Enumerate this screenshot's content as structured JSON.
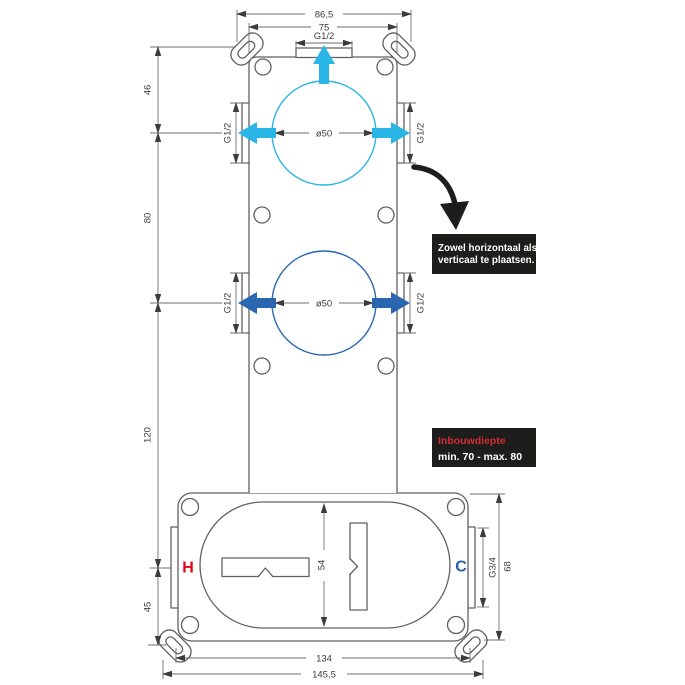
{
  "colors": {
    "cyan": "#29b5e6",
    "blue": "#2a67b0",
    "hot-red": "#e30613",
    "cold-blue": "#1e5fae",
    "note-red": "#d22b35",
    "panel-black": "#1d1d1b",
    "outline": "#606060",
    "dim": "#6e6e6e",
    "dim-text": "#3c3c3c"
  },
  "dims": {
    "top_outer": "86,5",
    "top_inner": "75",
    "thread_half": "G1/2",
    "circle_diameter": "ø50",
    "left_46": "46",
    "left_80": "80",
    "left_120": "120",
    "left_45": "45",
    "center_54": "54",
    "thread_34": "G3/4",
    "right_68": "68",
    "bottom_inner": "134",
    "bottom_outer": "145,5"
  },
  "ports": {
    "hot": "H",
    "cold": "C"
  },
  "notes": {
    "placement_line1": "Zowel horizontaal als",
    "placement_line2": "verticaal te plaatsen.",
    "depth_title": "Inbouwdiepte",
    "depth_range": "min. 70 - max. 80"
  }
}
